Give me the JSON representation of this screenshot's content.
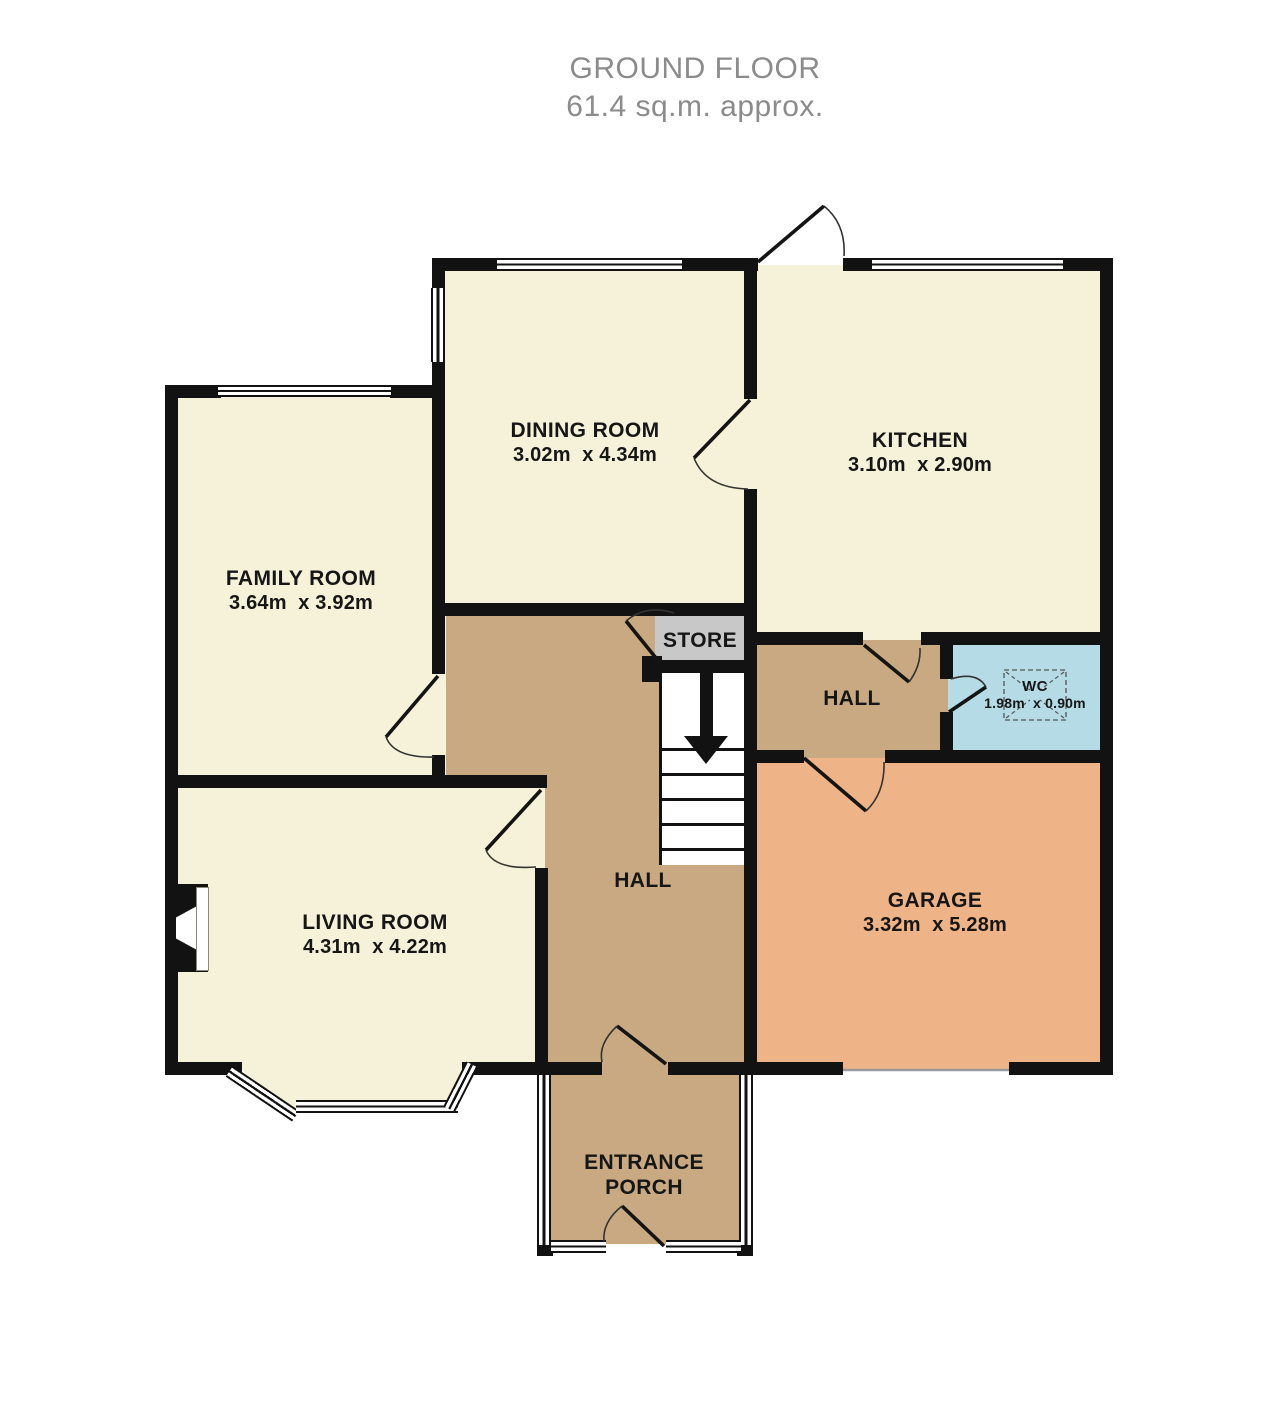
{
  "title": {
    "line1": "GROUND FLOOR",
    "line2": "61.4 sq.m. approx."
  },
  "rooms": {
    "dining": {
      "name": "DINING ROOM",
      "dims": "3.02m  x 4.34m"
    },
    "kitchen": {
      "name": "KITCHEN",
      "dims": "3.10m  x 2.90m"
    },
    "family": {
      "name": "FAMILY ROOM",
      "dims": "3.64m  x 3.92m"
    },
    "living": {
      "name": "LIVING ROOM",
      "dims": "4.31m  x 4.22m"
    },
    "garage": {
      "name": "GARAGE",
      "dims": "3.32m  x 5.28m"
    },
    "wc": {
      "name": "WC",
      "dims": "1.98m  x 0.90m"
    },
    "hall_rear": {
      "name": "HALL"
    },
    "hall_main": {
      "name": "HALL"
    },
    "store": {
      "name": "STORE"
    },
    "porch": {
      "name": "ENTRANCE PORCH"
    }
  },
  "colors": {
    "room_cream": "#f6f2da",
    "hall_tan": "#c8a982",
    "garage_orange": "#eeb488",
    "wc_blue": "#b5dce6",
    "store_gray": "#c8c8c8",
    "wall_black": "#121212",
    "title_gray": "#8b8b8b",
    "label_dark": "#161616"
  }
}
